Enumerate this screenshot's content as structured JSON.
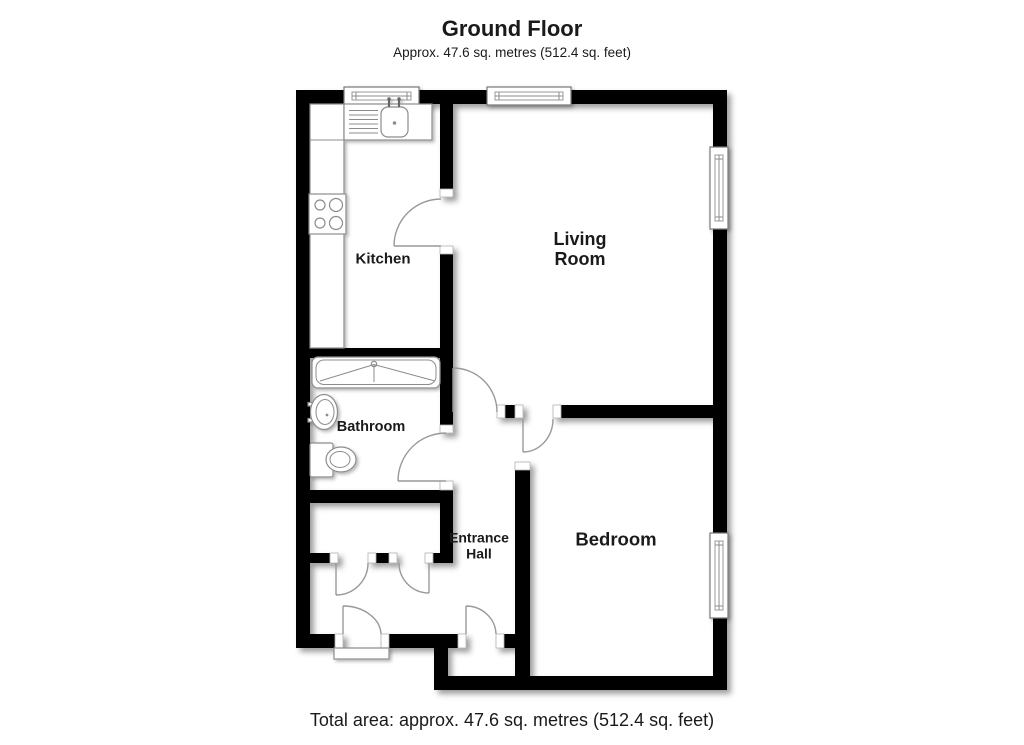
{
  "header": {
    "title": "Ground Floor",
    "subtitle": "Approx. 47.6 sq. metres (512.4 sq. feet)"
  },
  "rooms": {
    "kitchen": {
      "label": "Kitchen"
    },
    "living_room": {
      "label": "Living\nRoom"
    },
    "bathroom": {
      "label": "Bathroom"
    },
    "entrance_hall": {
      "label": "Entrance\nHall"
    },
    "bedroom": {
      "label": "Bedroom"
    }
  },
  "fixtures": {
    "kitchen_sink": "sink-with-drainer-icon",
    "kitchen_counter": "worktop-icon",
    "hob": "four-ring-hob-icon",
    "bath": "bath-with-shower-icon",
    "basin": "wash-basin-icon",
    "toilet": "toilet-icon",
    "entrance_step": "doorstep-icon"
  },
  "footer": {
    "total_area": "Total area: approx. 47.6 sq. metres (512.4 sq. feet)"
  },
  "colors": {
    "wall": "#000000",
    "background": "#ffffff",
    "door_line": "#999999",
    "fixture_line": "#8c8c8c",
    "text": "#1a1a1a"
  }
}
